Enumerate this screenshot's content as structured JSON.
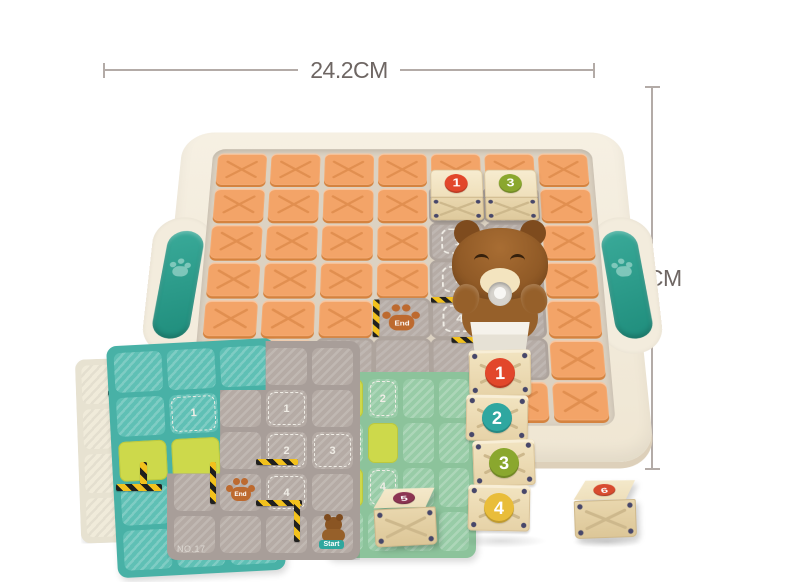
{
  "dimensions": {
    "width_label": "24.2CM",
    "height_label": "21CM"
  },
  "palette": {
    "tray": "#f4eee1",
    "tray_edge": "#ddd0ba",
    "handle_teal": "#2ba08f",
    "block_orange": "#f3a468",
    "block_orange_shade": "#d5833f",
    "board_gray": "#b6aca6",
    "wood": "#ecdbb4",
    "hazard_yellow": "#f2c11d",
    "hazard_black": "#20201e",
    "lime": "#cdd94b",
    "card_teal": "#48b1a6",
    "card_mint": "#8cc39b",
    "card_gray": "#a89e99",
    "card_beige": "#e7e2d1",
    "dim_line": "#b3aba7",
    "dim_text": "#6e6663"
  },
  "number_colors": {
    "1": "#e2472b",
    "2": "#2fa7a0",
    "3": "#8aa72e",
    "4": "#e9bd3a",
    "5": "#8c3452",
    "6": "#d84b2f"
  },
  "board": {
    "end_label": "End",
    "rows": [
      [
        "O",
        "O",
        "O",
        "O",
        "O",
        "O",
        "O"
      ],
      [
        "O",
        "O",
        "O",
        "O",
        "W1",
        "W3",
        "O"
      ],
      [
        "O",
        "O",
        "O",
        "O",
        "D1",
        "G",
        "O"
      ],
      [
        "O",
        "O",
        "O",
        "O",
        "D2",
        "D-",
        "O"
      ],
      [
        "O",
        "O",
        "O",
        "E",
        "D4",
        "G",
        "O"
      ],
      [
        "O",
        "O",
        "G",
        "G",
        "G",
        "G",
        "O"
      ],
      [
        "O",
        "O",
        "O",
        "O",
        "O",
        "O",
        "O"
      ]
    ]
  },
  "stack_blocks": [
    "1",
    "2",
    "3",
    "4"
  ],
  "loose_blocks": [
    "5",
    "6"
  ],
  "cards": {
    "gray": {
      "number_label": "NO.17",
      "end_label": "End",
      "start_label": "Start",
      "rows": [
        [
          "T",
          "T",
          "T",
          "T"
        ],
        [
          "T",
          "T",
          "D1",
          "T"
        ],
        [
          "T",
          "T",
          "D2",
          "D3"
        ],
        [
          "T",
          "E",
          "D4",
          "T"
        ],
        [
          "T",
          "T",
          "T",
          "S"
        ]
      ]
    },
    "teal": {
      "rows": [
        [
          "T",
          "T",
          "T"
        ],
        [
          "T",
          "D1",
          "T"
        ],
        [
          "L",
          "L",
          "T"
        ],
        [
          "T",
          "T",
          "T"
        ],
        [
          "T",
          "T",
          "T"
        ]
      ]
    },
    "mint": {
      "rows": [
        [
          "L",
          "D2",
          "T",
          "T"
        ],
        [
          "D3",
          "L",
          "T",
          "T"
        ],
        [
          "L",
          "D4",
          "T",
          "T"
        ],
        [
          "T",
          "T",
          "T",
          "T"
        ]
      ]
    },
    "beige": {
      "rows": [
        [
          "T",
          "T"
        ],
        [
          "T",
          "T"
        ],
        [
          "T",
          "T"
        ],
        [
          "T",
          "T"
        ]
      ]
    }
  }
}
